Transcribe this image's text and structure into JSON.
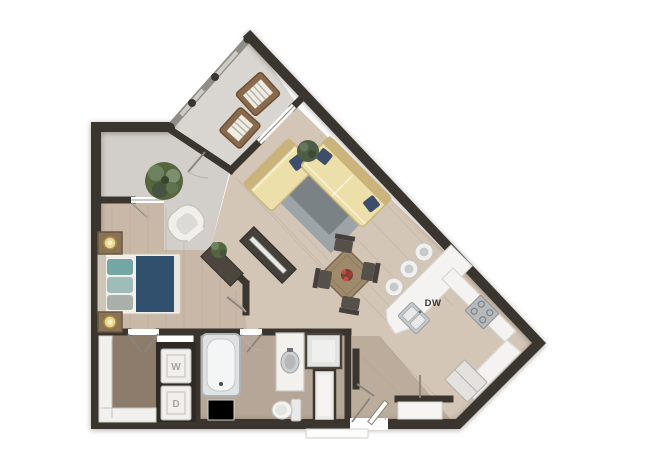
{
  "floorplan": {
    "labels": {
      "washer": "W",
      "dryer": "D",
      "dishwasher": "DW"
    },
    "colors": {
      "wall": "#3b352f",
      "wood_living": "#d4c6b6",
      "wood_bedroom": "#c9b8a7",
      "wood_bathroom": "#b6a697",
      "wood_closet": "#8d7b6b",
      "grey_balcony": "#d9d6d2",
      "grey_entry": "#d2cec9",
      "counter_white": "#f4f3f1",
      "bed_navy": "#31506e",
      "pillow_teal": "#74a7a4",
      "sofa_cream": "#ecdfa9",
      "sofa_trim": "#cbb47c",
      "rug_grey": "#9aa2a8",
      "rug_dark": "#757d7f",
      "table_wood": "#a08a6c",
      "chair_dark": "#45403b",
      "appliance_grey": "#b7babc",
      "plant_green": "#55663f",
      "railing_grey": "#908c86",
      "label_grey": "#a8a39b"
    },
    "rooms": [
      {
        "name": "balcony"
      },
      {
        "name": "entry"
      },
      {
        "name": "bedroom"
      },
      {
        "name": "living-room"
      },
      {
        "name": "dining-area"
      },
      {
        "name": "kitchen"
      },
      {
        "name": "bathroom"
      },
      {
        "name": "walk-in-closet"
      },
      {
        "name": "laundry"
      },
      {
        "name": "hallway"
      }
    ]
  }
}
